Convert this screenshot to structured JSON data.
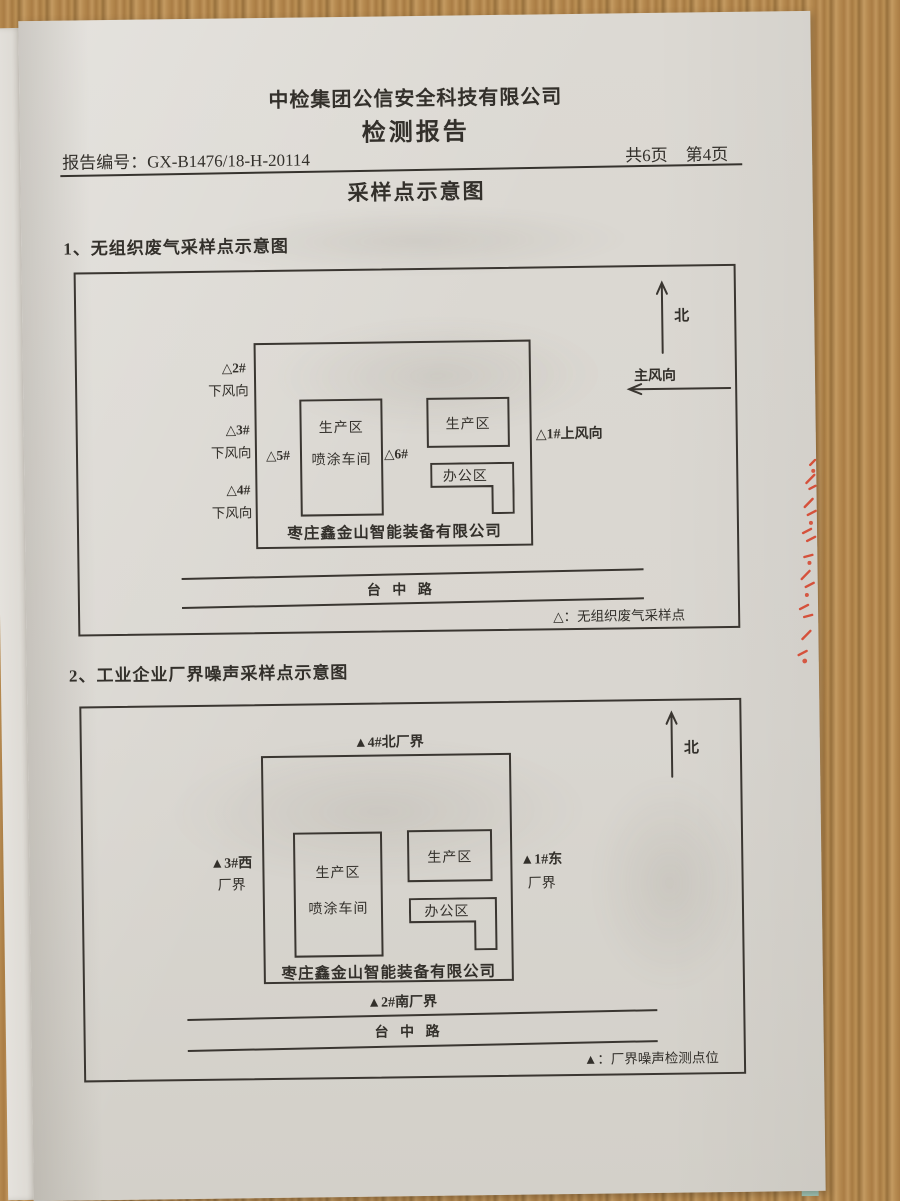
{
  "page": {
    "company": "中检集团公信安全科技有限公司",
    "doc_title": "检测报告",
    "report_no_label": "报告编号：",
    "report_no": "GX-B1476/18-H-20114",
    "pages_total": "共6页",
    "pages_current": "第4页",
    "section_title": "采样点示意图"
  },
  "diagram1": {
    "heading": "1、无组织废气采样点示意图",
    "north_label": "北",
    "wind_label": "主风向",
    "areas": {
      "production": "生产区",
      "spray_workshop": "喷涂车间",
      "office": "办公区"
    },
    "company_label": "枣庄鑫金山智能装备有限公司",
    "points": {
      "p1": "△1#上风向",
      "p2": "△2#",
      "p2_sub": "下风向",
      "p3": "△3#",
      "p3_sub": "下风向",
      "p4": "△4#",
      "p4_sub": "下风向",
      "p5": "△5#",
      "p6": "△6#"
    },
    "road": "台 中 路",
    "legend": "△：无组织废气采样点"
  },
  "diagram2": {
    "heading": "2、工业企业厂界噪声采样点示意图",
    "north_label": "北",
    "areas": {
      "production": "生产区",
      "spray_workshop": "喷涂车间",
      "office": "办公区"
    },
    "company_label": "枣庄鑫金山智能装备有限公司",
    "points": {
      "north_boundary": "▲4#北厂界",
      "south_boundary": "▲2#南厂界",
      "west_line1": "▲3#西",
      "west_line2": "厂界",
      "east_line1": "▲1#东",
      "east_line2": "厂界"
    },
    "road": "台 中 路",
    "legend": "▲：厂界噪声检测点位"
  },
  "colors": {
    "ink": "#33302b",
    "page": "#d9d6d0",
    "wood": "#b5894f",
    "teal_edge": "#a3cabd",
    "stamp_red": "#d5432c"
  }
}
